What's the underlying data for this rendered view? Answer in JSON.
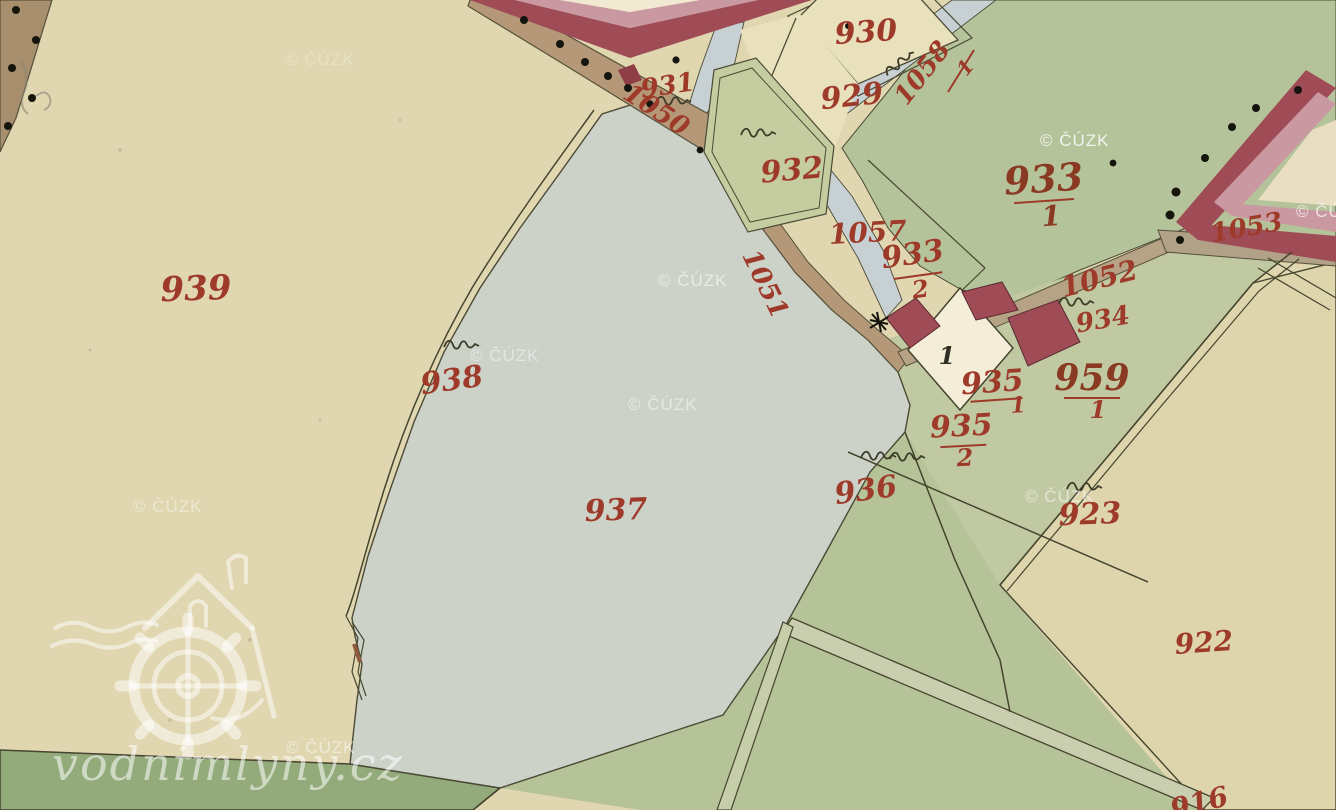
{
  "parcels": {
    "p939": "939",
    "p938": "938",
    "p937": "937",
    "p936": "936",
    "p932": "932",
    "p931": "931",
    "p930": "930",
    "p929": "929",
    "p934": "934",
    "p923": "923",
    "p922": "922",
    "p933_1_num": "933",
    "p933_1_den": "1",
    "p933_2_num": "933",
    "p933_2_den": "2",
    "p935_1_num": "935",
    "p935_1_den": "1",
    "p935_2_num": "935",
    "p935_2_den": "2",
    "p959_1_num": "959",
    "p959_1_den": "1",
    "bottom_partial": "916"
  },
  "waterways_roads": {
    "w1050": "1050",
    "w1051": "1051",
    "w1052": "1052",
    "w1053": "1053",
    "w1057": "1057",
    "w1058_num": "1058",
    "w1058_den": "1"
  },
  "house_numbers": {
    "n1": "1"
  },
  "watermarks": {
    "cuzk": "© ČÚZK",
    "site": "vodnimlyny.cz"
  },
  "icons": {
    "meadow_symbol": "grass/meadow squiggle mark",
    "tree_dot": "tree dot along road",
    "star_symbol": "survey star mark",
    "mill_logo": "watermill house with waterwheel"
  },
  "colors": {
    "paper": "#e0d7b1",
    "paper_light": "#e9e0bc",
    "green": "#b5c39a",
    "green_mid": "#c0c9a1",
    "green_wedge": "#b6c297",
    "green_dark": "#93ab7b",
    "beige_922": "#ded5ad",
    "pond": "#cdd2c9",
    "stream": "#c7d0d3",
    "road": "#b59878",
    "road_pale": "#c9cfae",
    "building_dark": "#a04c56",
    "building_pink": "#c998a0",
    "building_white": "#f4edd8",
    "courtyard": "#f1e9d2",
    "line": "#46452f",
    "label_red": "#9e3a2a",
    "watermark": "#ffffff"
  }
}
